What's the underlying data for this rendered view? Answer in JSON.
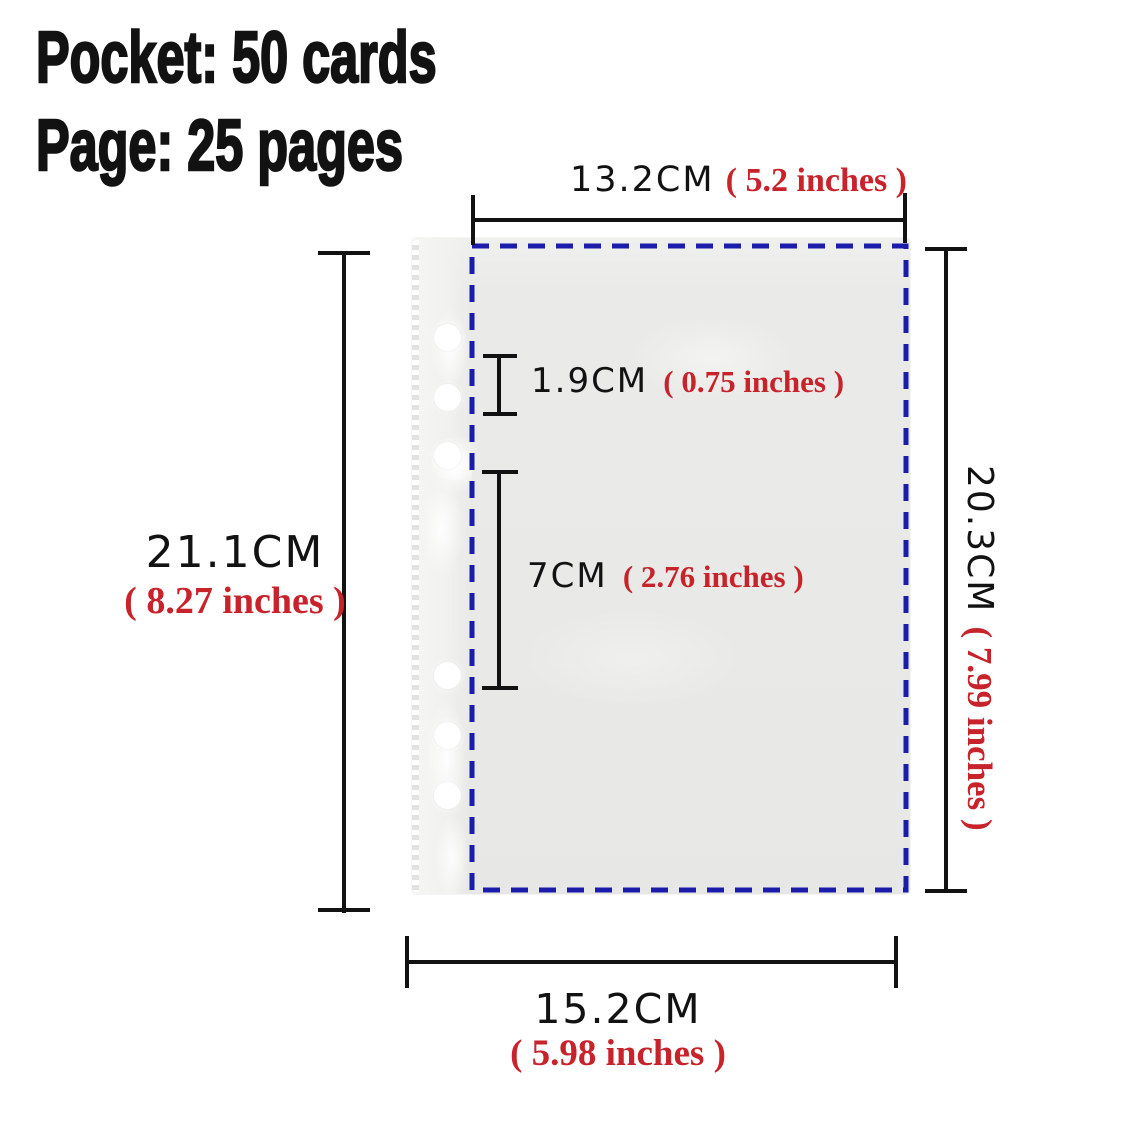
{
  "header": {
    "pocket_line": "Pocket: 50 cards",
    "page_line": "Page: 25 pages"
  },
  "dimensions": {
    "inner_width": {
      "cm": "13.2CM",
      "inches": "( 5.2 inches )"
    },
    "page_height": {
      "cm": "21.1CM",
      "inches": "( 8.27 inches )"
    },
    "inner_height": {
      "cm": "20.3CM",
      "inches": "( 7.99 inches )"
    },
    "page_width": {
      "cm": "15.2CM",
      "inches": "( 5.98 inches )"
    },
    "pocket_top_gap": {
      "cm": "1.9CM",
      "inches": "( 0.75 inches )"
    },
    "pocket_height": {
      "cm": "7CM",
      "inches": "( 2.76 inches )"
    }
  },
  "colors": {
    "ink": "#121212",
    "accent_red": "#c8232b",
    "accent_blue": "#1c1caa"
  }
}
